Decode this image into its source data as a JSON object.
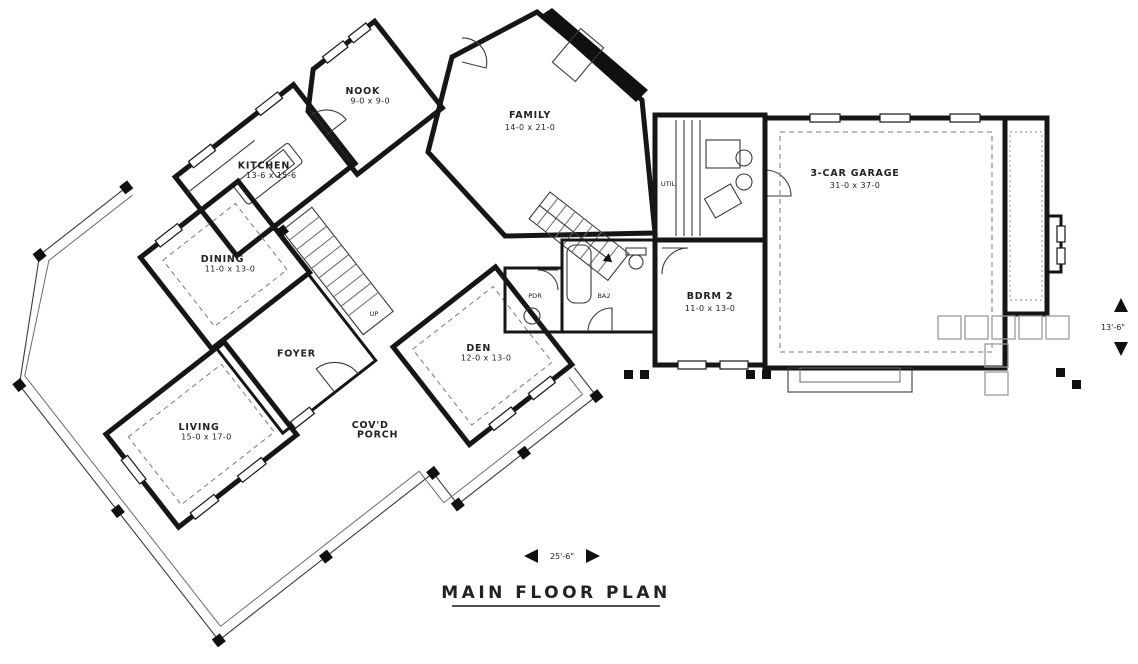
{
  "title": "MAIN FLOOR PLAN",
  "rooms": {
    "nook": {
      "name": "NOOK",
      "dims": "9-0 x 9-0"
    },
    "family": {
      "name": "FAMILY",
      "dims": "14-0 x 21-0"
    },
    "kitchen": {
      "name": "KITCHEN",
      "dims": "13-6 x 15-6"
    },
    "dining": {
      "name": "DINING",
      "dims": "11-0 x 13-0"
    },
    "foyer": {
      "name": "FOYER"
    },
    "living": {
      "name": "LIVING",
      "dims": "15-0 x 17-0"
    },
    "den": {
      "name": "DEN",
      "dims": "12-0 x 13-0"
    },
    "covd_porch": {
      "line1": "COV'D",
      "line2": "PORCH"
    },
    "bdrm2": {
      "name": "BDRM 2",
      "dims": "11-0 x 13-0"
    },
    "garage": {
      "name": "3-CAR GARAGE",
      "dims": "31-0 x 37-0"
    },
    "pdr": {
      "name": "PDR"
    },
    "ba2": {
      "name": "BA2"
    },
    "util": {
      "name": "UTIL"
    }
  },
  "stairs": {
    "up_label": "UP"
  },
  "dimensions": {
    "bottom_width": "25'-6\"",
    "right_height": "13'-6\""
  },
  "colors": {
    "ink": "#161616",
    "paper": "#ffffff"
  }
}
